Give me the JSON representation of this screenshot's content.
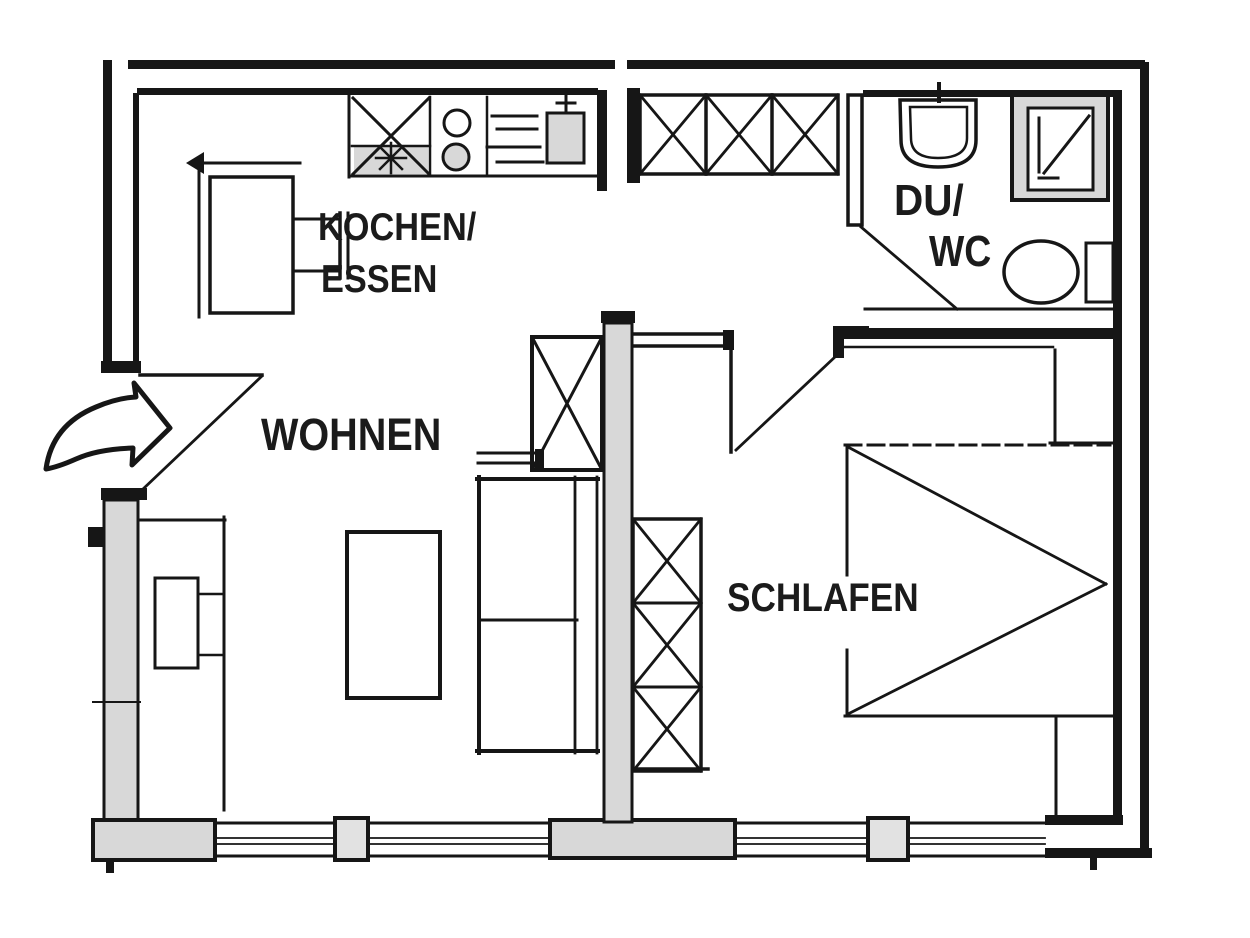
{
  "drawing": {
    "kind": "apartment-floor-plan",
    "style": "hand-drawn black ink on white"
  },
  "colors": {
    "line": "#161616",
    "wall_fill": "#d8d8d8",
    "mullion_fill": "#e2e2e2",
    "background": "#ffffff"
  },
  "rooms": {
    "kitchen": {
      "label_line1": "KOCHEN/",
      "label_line2": "ESSEN"
    },
    "living": {
      "label": "WOHNEN"
    },
    "bath": {
      "label_line1": "DU/",
      "label_line2": "WC"
    },
    "bedroom": {
      "label": "SCHLAFEN"
    }
  },
  "entrance": {
    "icon": "curved-arrow-right"
  },
  "fixtures": {
    "kitchen": [
      "dining-table",
      "chair",
      "corner-bench",
      "kitchen-counter",
      "sink-unit",
      "stove-2-burners",
      "boiler-unit"
    ],
    "hall": [
      "built-in-closet-3-cells"
    ],
    "bath": [
      "washbasin",
      "shower",
      "toilet"
    ],
    "living": [
      "sideboard-with-tv",
      "coffee-table",
      "sofa-2-seat",
      "cabinet"
    ],
    "bedroom": [
      "wardrobe-3-cells",
      "double-bed",
      "nightstand-top",
      "nightstand-bottom"
    ],
    "windows": [
      "window-a",
      "window-b",
      "window-c",
      "window-d"
    ]
  }
}
